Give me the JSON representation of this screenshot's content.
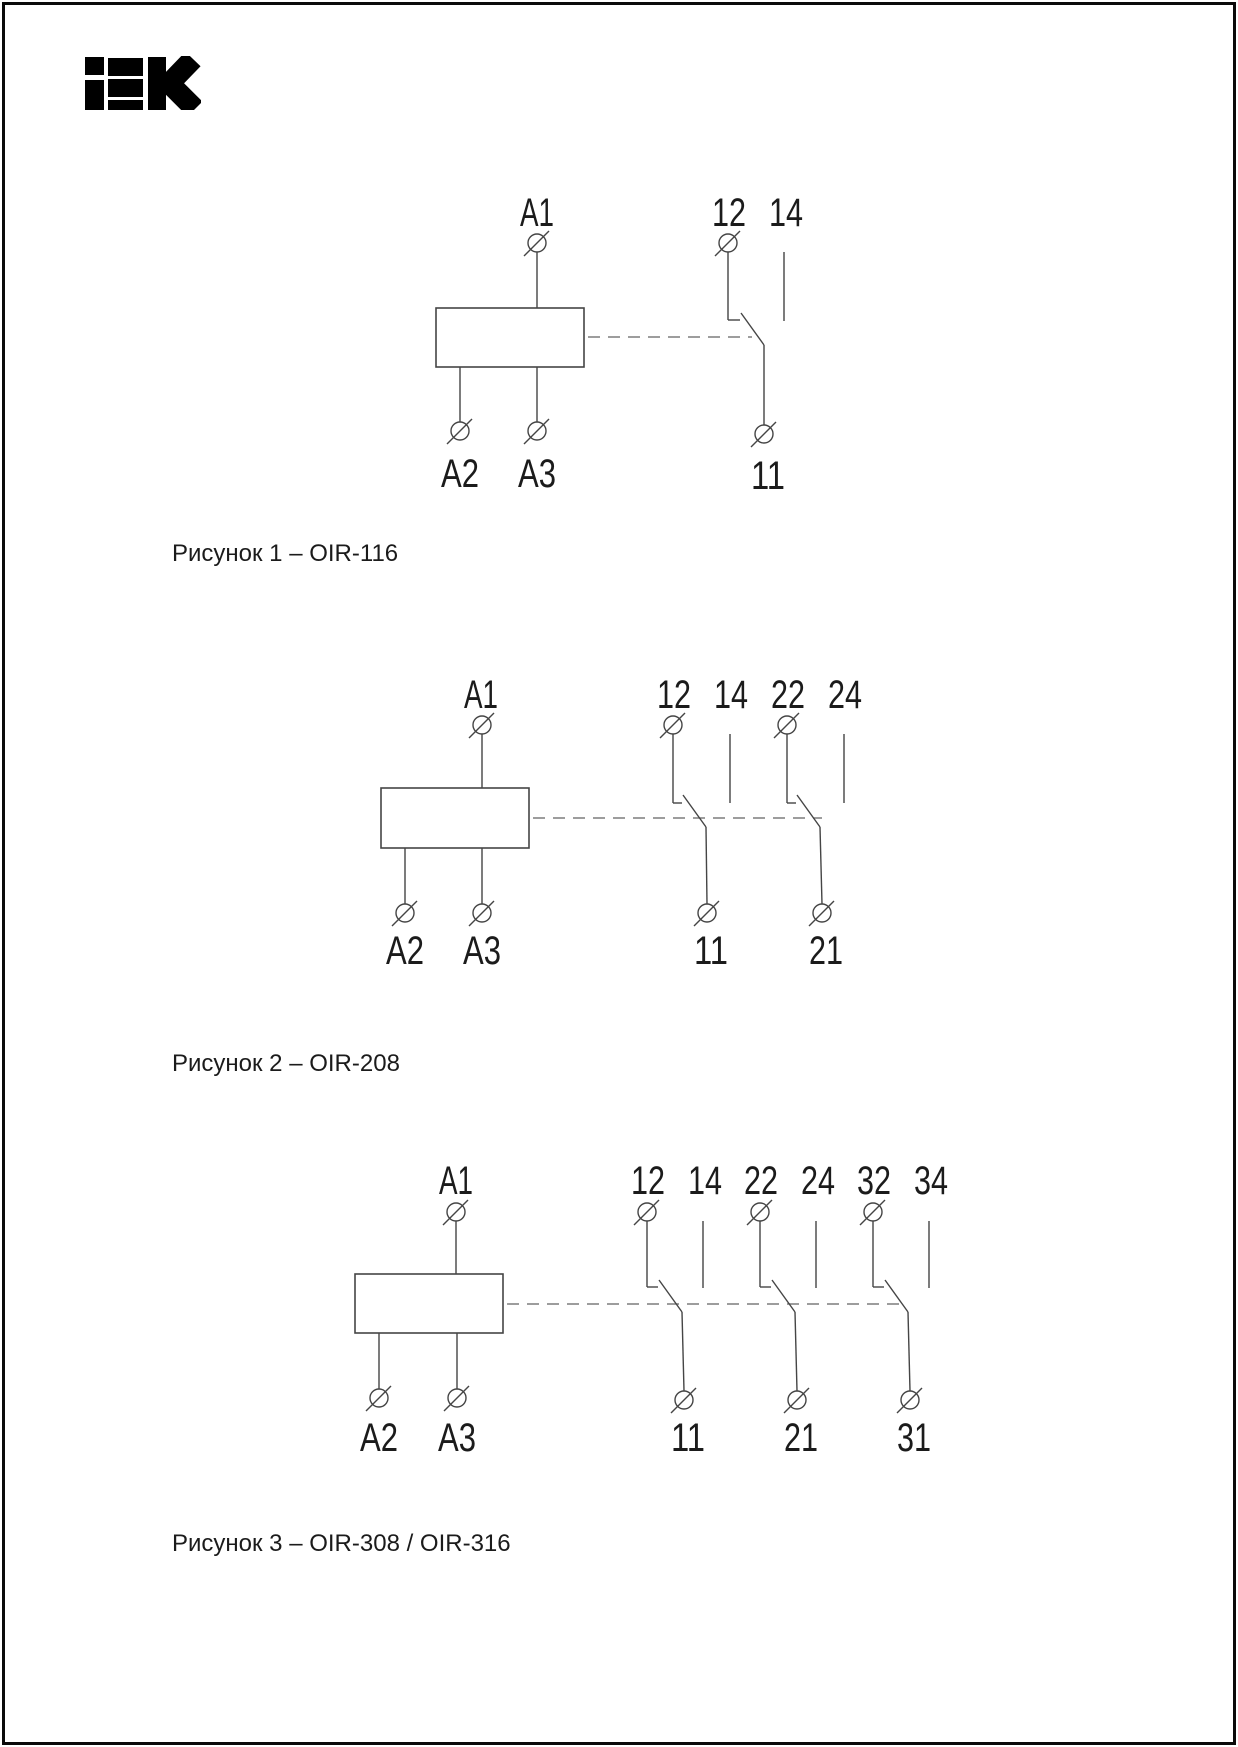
{
  "logo": {
    "text": "IEK"
  },
  "colors": {
    "line": "#454545",
    "dashed_line": "#7d7d7d",
    "text": "#1b1b1b",
    "logo": "#000000",
    "frame": "#0a0a0a",
    "background": "#ffffff"
  },
  "figures": [
    {
      "caption": "Рисунок 1 – OIR-116",
      "coil": {
        "top": "A1",
        "bottom_left": "A2",
        "bottom_right": "A3"
      },
      "contacts": [
        {
          "nc": "12",
          "no": "14",
          "common": "11"
        }
      ]
    },
    {
      "caption": "Рисунок 2 – OIR-208",
      "coil": {
        "top": "A1",
        "bottom_left": "A2",
        "bottom_right": "A3"
      },
      "contacts": [
        {
          "nc": "12",
          "no": "14",
          "common": "11"
        },
        {
          "nc": "22",
          "no": "24",
          "common": "21"
        }
      ]
    },
    {
      "caption": "Рисунок 3 – OIR-308 / OIR-316",
      "coil": {
        "top": "A1",
        "bottom_left": "A2",
        "bottom_right": "A3"
      },
      "contacts": [
        {
          "nc": "12",
          "no": "14",
          "common": "11"
        },
        {
          "nc": "22",
          "no": "24",
          "common": "21"
        },
        {
          "nc": "32",
          "no": "34",
          "common": "31"
        }
      ]
    }
  ]
}
